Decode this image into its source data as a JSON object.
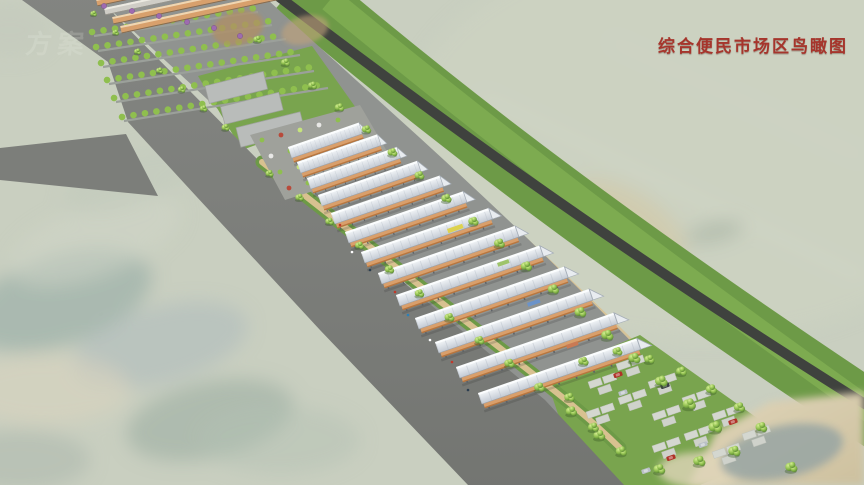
{
  "title": {
    "text": "综合便民市场区鸟瞰图"
  },
  "watermark": {
    "text": "方案"
  },
  "colors": {
    "title_red": "#a6352c",
    "terrain": "#c9cfc0",
    "road": "#7c7e7a",
    "dark_road": "#3f423e",
    "green_belt": "#6d9a47",
    "green_belt_outer": "#7dab50",
    "grass": "#79a44e",
    "paving": "#909390",
    "tree_green": "#8fbf4e",
    "canopy": "#dfe5ea",
    "stall": "#d99f6b",
    "stall_dark": "#b9763e",
    "path": "#d8c190",
    "shed": "#b9bcba",
    "sand": "#d8cdb0",
    "pond": "#98a5a3",
    "blossom": "#9e6bb0",
    "car_red": "#b03228",
    "car_dark": "#3a3f45",
    "car_silver": "#b9c0c6"
  }
}
